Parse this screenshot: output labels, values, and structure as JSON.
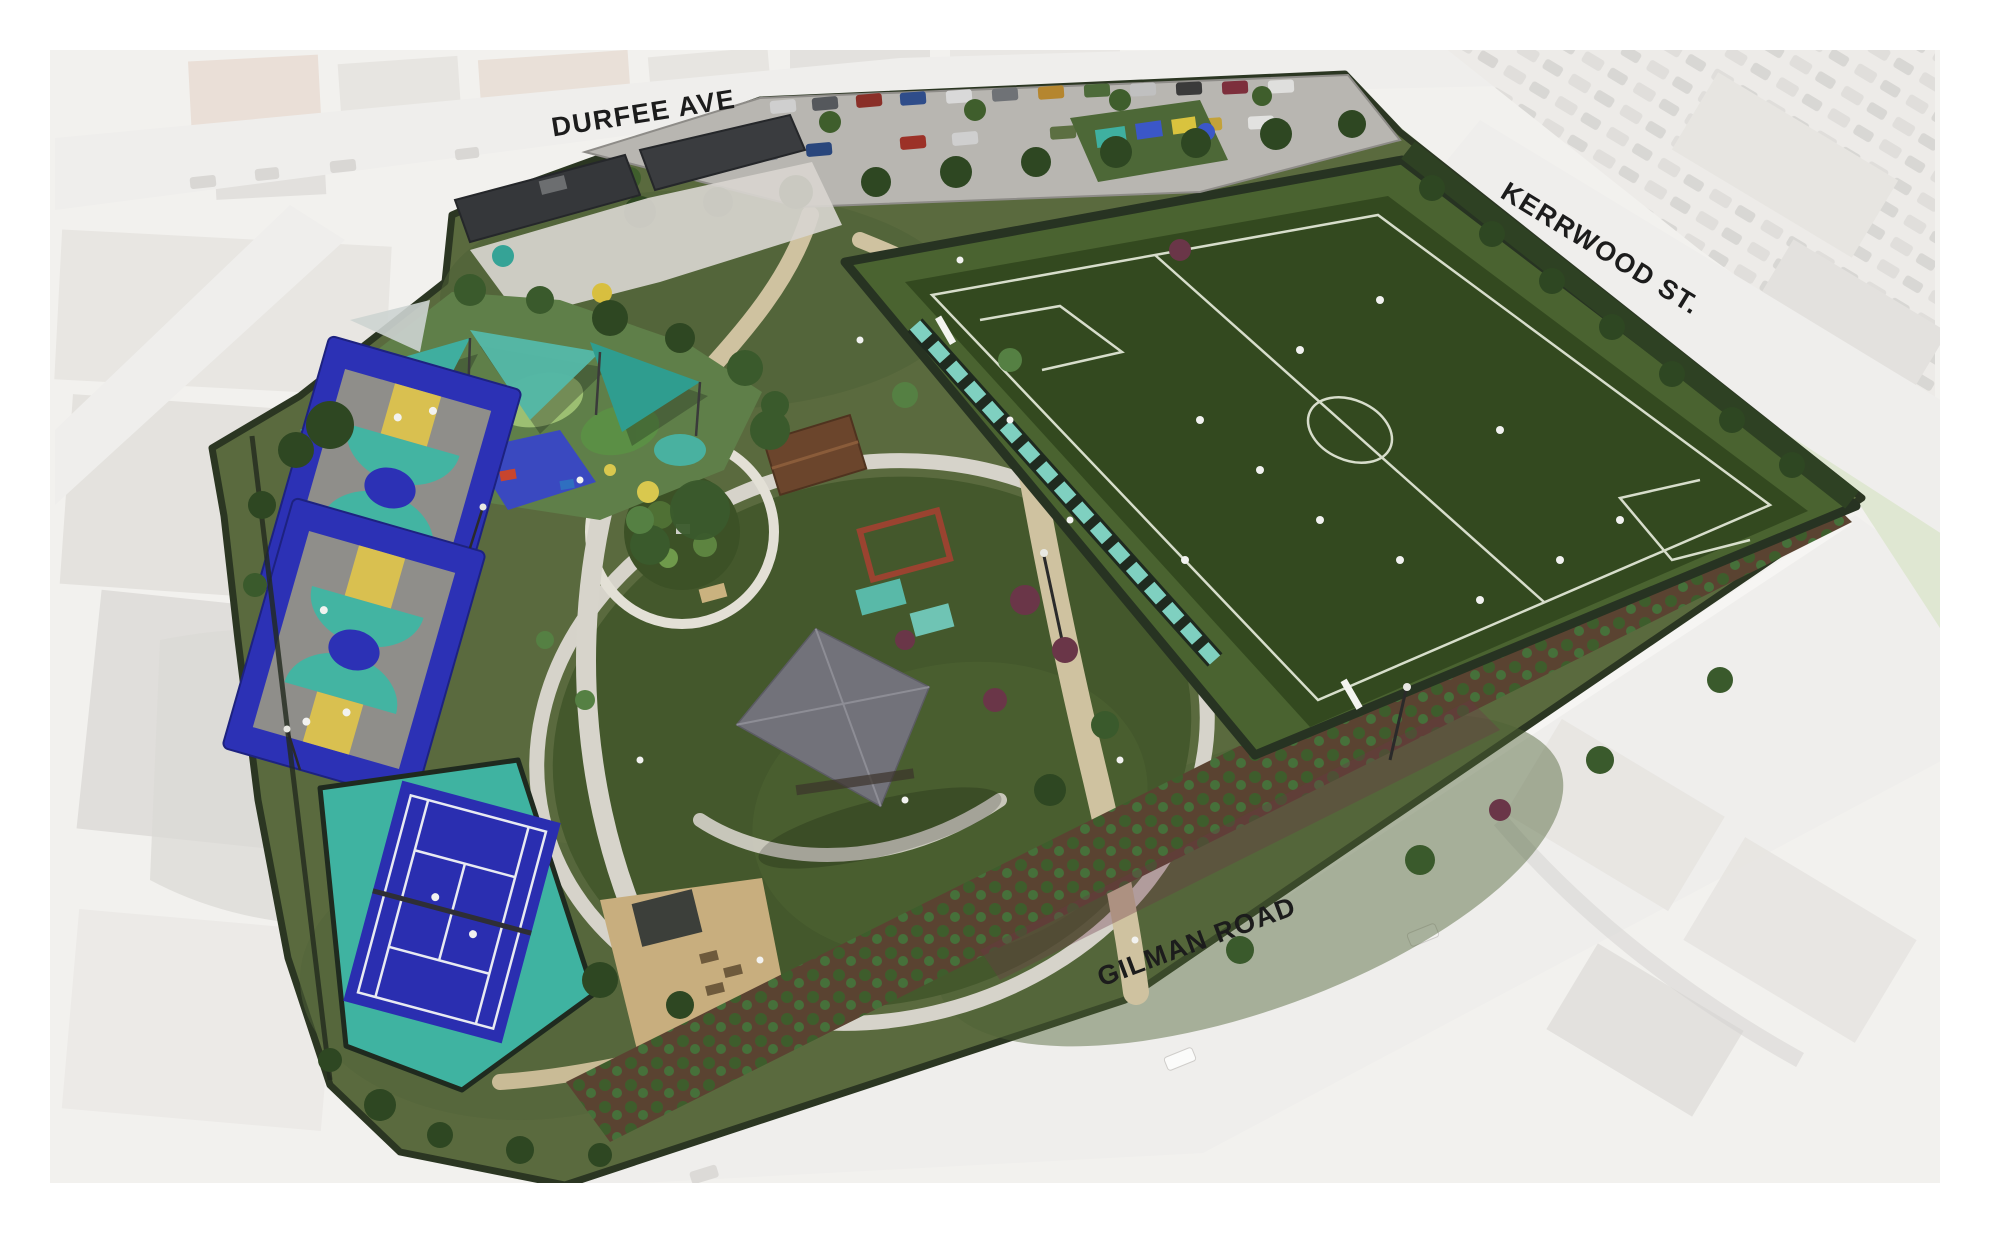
{
  "image": {
    "type": "aerial-site-plan-rendering",
    "subject": "park master plan over faded neighborhood aerial photo"
  },
  "streets": {
    "durfee": "DURFEE AVE",
    "kerrwood": "KERRWOOD ST.",
    "gilman": "GILMAN ROAD"
  },
  "palette": {
    "canvas": "#ffffff",
    "aerial_base": "#f2f1ee",
    "aerial_block": "#e7e5e1",
    "aerial_block_warm": "#eadfd7",
    "aerial_road": "#efeeec",
    "aerial_shadow": "#dcdad7",
    "sage_strip": "#dfe7d2",
    "park_ground": "#5a6a3e",
    "hedge_dark": "#2b3622",
    "soccer_surround": "#4a6330",
    "soccer_turf": "#33491f",
    "field_line": "#e9eede",
    "bleacher_teal": "#7fd0c0",
    "great_lawn": "#44582c",
    "path_tan": "#cfc2a0",
    "path_concrete": "#d7d4cb",
    "plaza_dg": "#c8ae7e",
    "court_blue": "#2c31b5",
    "court_gray": "#8f8e8a",
    "court_teal": "#43b4a2",
    "court_yellow": "#d9c050",
    "tennis_apron": "#3fb3a1",
    "tennis_blue": "#2a2eb0",
    "sail_teal_1": "#3fae9f",
    "sail_teal_2": "#54b8a8",
    "sail_teal_3": "#2f9d8f",
    "sail_gray": "#cdd4d2",
    "rubber_purple": "#7b5ba6",
    "rubber_magenta": "#a85f9e",
    "rubber_blue": "#3a49c0",
    "rubber_green": "#5b8f45",
    "rubber_green_light": "#9cbf72",
    "roof_dark": "#35373a",
    "roof_gray": "#72727a",
    "roof_brown": "#6b452c",
    "pergola_red": "#9a4330",
    "parking_asphalt": "#b8b6b1",
    "mulch": "#5a4331",
    "shrub_green": "#3e5d2c",
    "shrub_burgundy": "#6d3747",
    "tree_dark": "#2e4722",
    "tree_mid": "#3a5a2c",
    "tree_light": "#558043",
    "tree_burgundy": "#6a3648",
    "figure_white": "#f2f2f0",
    "label_ink": "#1c1c1c"
  }
}
